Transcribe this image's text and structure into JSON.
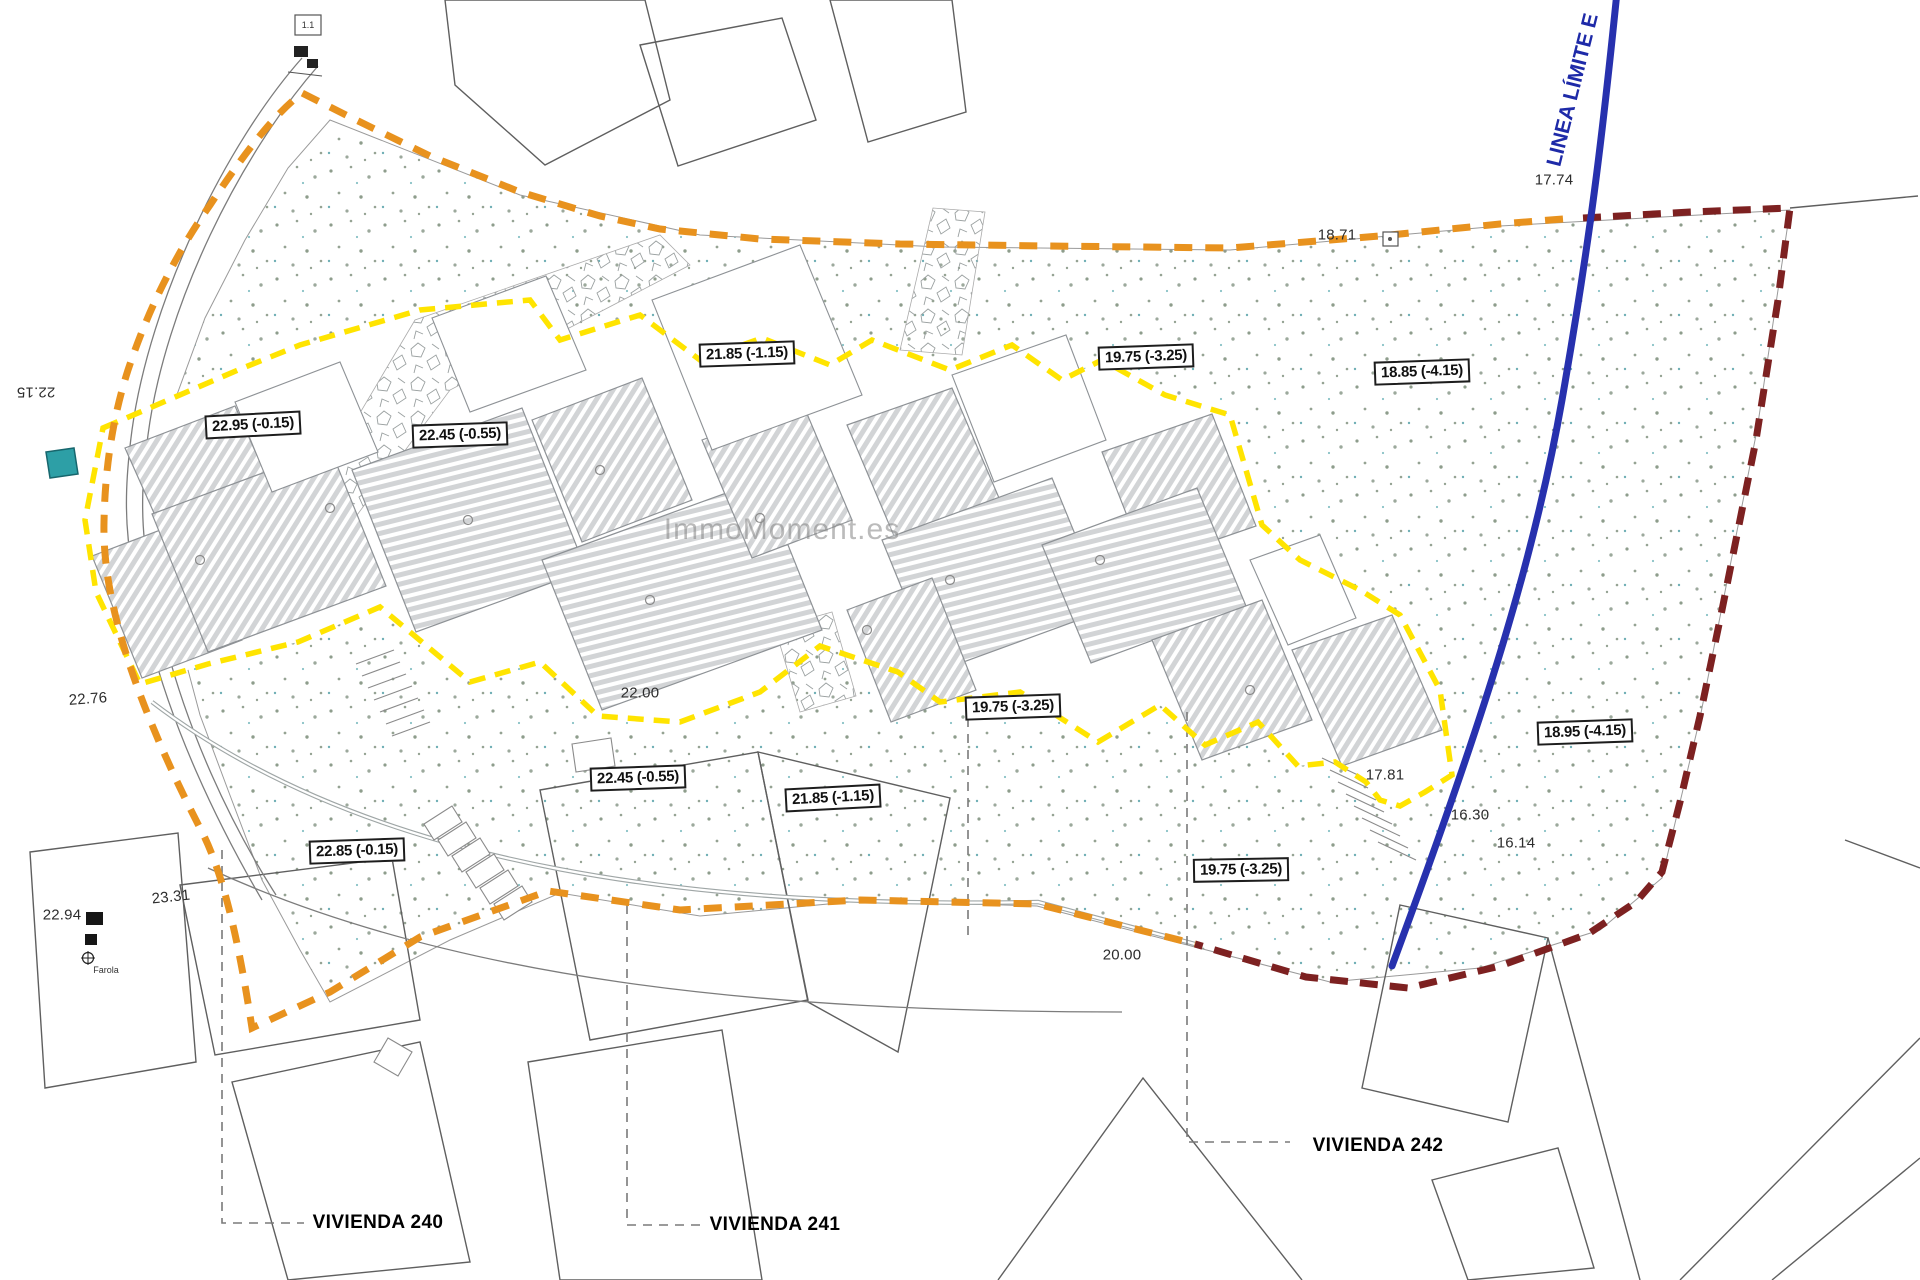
{
  "plan": {
    "watermark": "ImmoMoment.es",
    "limit_line_label": "LINEA LÍMITE E",
    "houses": {
      "v240": "VIVIENDA 240",
      "v241": "VIVIENDA 241",
      "v242": "VIVIENDA 242"
    },
    "elevation_boxes": {
      "b1": "22.95 (-0.15)",
      "b2": "22.45 (-0.55)",
      "b3": "21.85 (-1.15)",
      "b4": "19.75 (-3.25)",
      "b5": "18.85 (-4.15)",
      "b6": "22.45 (-0.55)",
      "b7": "21.85 (-1.15)",
      "b8": "22.85 (-0.15)",
      "b9": "19.75 (-3.25)",
      "b10": "19.75 (-3.25)",
      "b11": "18.95 (-4.15)"
    },
    "spot_elevations": {
      "s1": "22.15",
      "s2": "22.76",
      "s3": "23.31",
      "s4": "22.94",
      "s5": "17.74",
      "s6": "18.71",
      "s7": "17.81",
      "s8": "16.30",
      "s9": "16.14",
      "s10": "20.00",
      "s11": "22.00"
    },
    "markers": {
      "ref_box": "1.1",
      "streetlight": "Farola"
    },
    "colors": {
      "boundary_orange": "#E8921E",
      "boundary_dark_red": "#7D2121",
      "building_outline_yellow": "#FFE400",
      "limit_line_blue": "#2731AE",
      "pool_teal": "#2D9FA6"
    }
  }
}
